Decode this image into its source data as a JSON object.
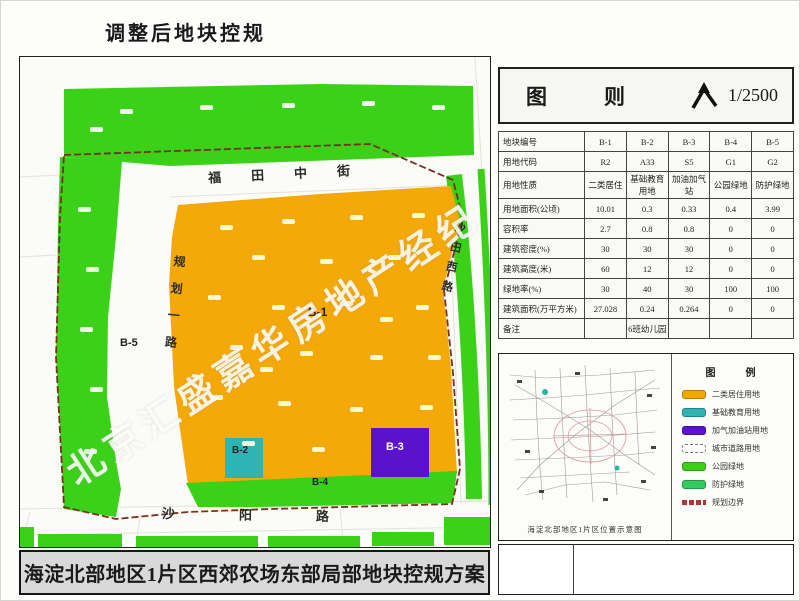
{
  "page": {
    "title": "调整后地块控规"
  },
  "map": {
    "streets": {
      "top": "福田中街",
      "left": "规划一路",
      "right": "沙田西路",
      "bottom": "沙阳路"
    },
    "plots": [
      "B-1",
      "B-2",
      "B-3",
      "B-4",
      "B-5"
    ],
    "watermark": "北京汇盛嘉华房地产经纪",
    "banner": "海淀北部地区1片区西郊农场东部局部地块控规方案"
  },
  "panel": {
    "header": {
      "title": "图　则",
      "scale": "1/2500"
    },
    "table": {
      "rows": [
        {
          "label": "地块编号",
          "values": [
            "B-1",
            "B-2",
            "B-3",
            "B-4",
            "B-5"
          ]
        },
        {
          "label": "用地代码",
          "values": [
            "R2",
            "A33",
            "S5",
            "G1",
            "G2"
          ]
        },
        {
          "label": "用地性质",
          "values": [
            "二类居住",
            "基础教育用地",
            "加油加气站",
            "公园绿地",
            "防护绿地"
          ]
        },
        {
          "label": "用地面积(公顷)",
          "values": [
            "10.01",
            "0.3",
            "0.33",
            "0.4",
            "3.99"
          ]
        },
        {
          "label": "容积率",
          "values": [
            "2.7",
            "0.8",
            "0.8",
            "0",
            "0"
          ]
        },
        {
          "label": "建筑密度(%)",
          "values": [
            "30",
            "30",
            "30",
            "0",
            "0"
          ]
        },
        {
          "label": "建筑高度(米)",
          "values": [
            "60",
            "12",
            "12",
            "0",
            "0"
          ]
        },
        {
          "label": "绿地率(%)",
          "values": [
            "30",
            "40",
            "30",
            "100",
            "100"
          ]
        },
        {
          "label": "建筑面积(万平方米)",
          "values": [
            "27.028",
            "0.24",
            "0.264",
            "0",
            "0"
          ]
        },
        {
          "label": "备注",
          "values": [
            "",
            "6班幼儿园",
            "",
            "",
            ""
          ]
        }
      ]
    },
    "legend": {
      "title": "图　例",
      "items": [
        {
          "label": "二类居住用地",
          "color": "#F2A705",
          "type": "fill"
        },
        {
          "label": "基础教育用地",
          "color": "#2FB3B3",
          "type": "fill"
        },
        {
          "label": "加气加油站用地",
          "color": "#5A12CC",
          "type": "fill"
        },
        {
          "label": "城市道路用地",
          "color": "#FFFFFF",
          "type": "dashed-fill"
        },
        {
          "label": "公园绿地",
          "color": "#3BD119",
          "type": "fill"
        },
        {
          "label": "防护绿地",
          "color": "#35C95E",
          "type": "fill"
        },
        {
          "label": "规划边界",
          "color": "#B03434",
          "type": "dashed-line"
        }
      ],
      "minimap_caption": "海淀北部地区1片区位置示意图"
    }
  },
  "colors": {
    "residential_orange": "#F4A908",
    "education_teal": "#2FB3B3",
    "gas_purple": "#5A12CC",
    "park_green": "#3BD119",
    "boundary_red": "#7A2F1F"
  }
}
